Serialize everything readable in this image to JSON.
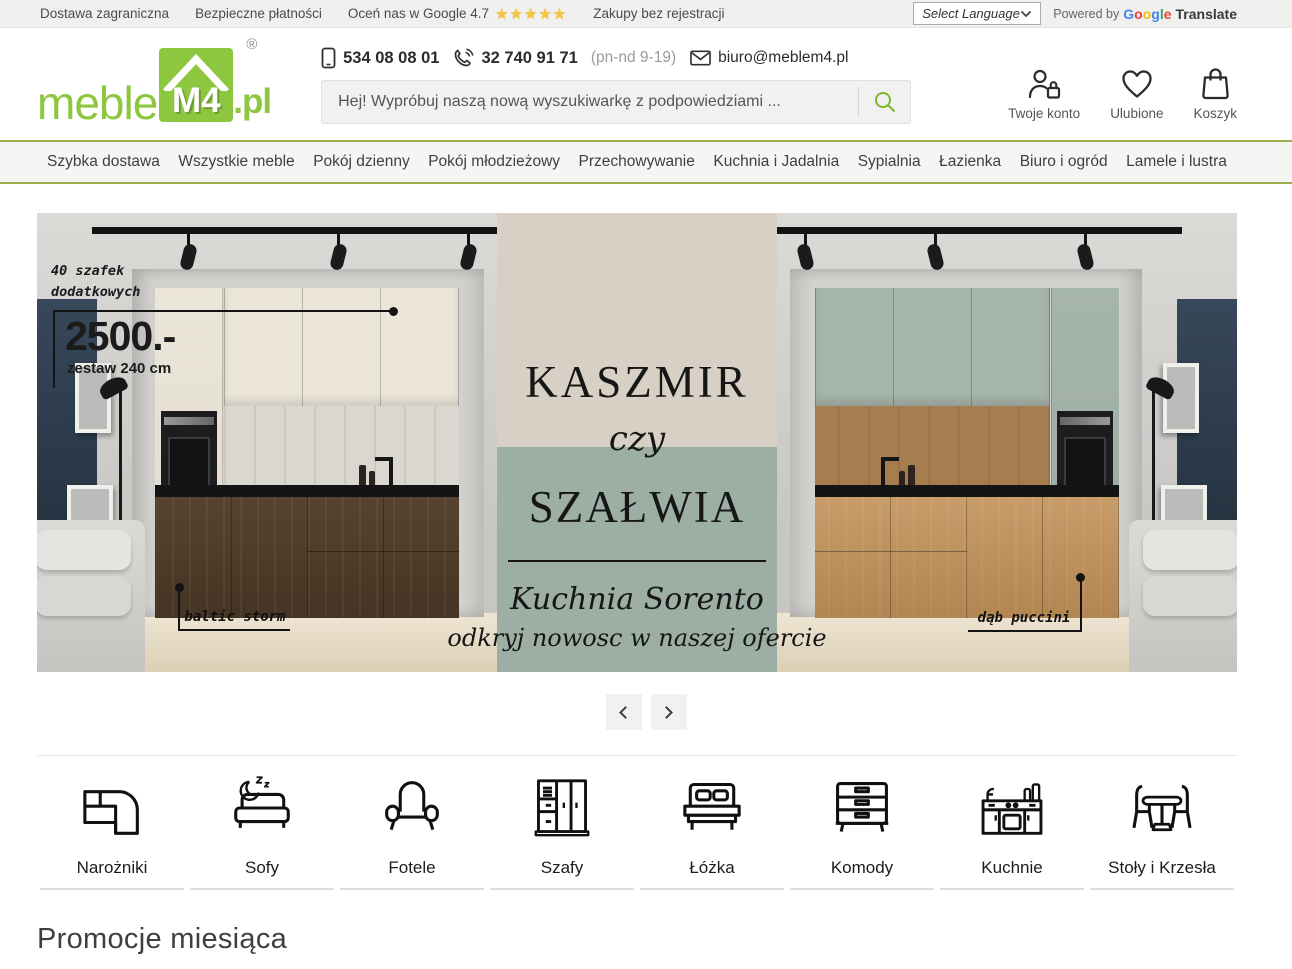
{
  "topbar": {
    "link_foreign_delivery": "Dostawa zagraniczna",
    "link_secure_payments": "Bezpieczne płatności",
    "link_google_rating": "Oceń nas w Google 4.7",
    "stars": "★★★★★",
    "link_no_registration": "Zakupy bez rejestracji",
    "language_select_label": "Select Language",
    "powered_by": "Powered by",
    "google_letters": [
      "G",
      "o",
      "o",
      "g",
      "l",
      "e"
    ],
    "translate": "Translate"
  },
  "header": {
    "logo": {
      "meble": "meble",
      "m4": "M4",
      "pl": ".pl",
      "registered": "®"
    },
    "phone_mobile": "534 08 08 01",
    "phone_landline": "32 740 91 71",
    "phone_hours": "(pn-nd 9-19)",
    "email": "biuro@meblem4.pl",
    "search_placeholder": "Hej! Wypróbuj naszą nową wyszukiwarkę z podpowiedziami ...",
    "account_label": "Twoje konto",
    "favorites_label": "Ulubione",
    "cart_label": "Koszyk"
  },
  "nav": {
    "items": [
      {
        "label": "Szybka dostawa"
      },
      {
        "label": "Wszystkie meble"
      },
      {
        "label": "Pokój dzienny"
      },
      {
        "label": "Pokój młodzieżowy"
      },
      {
        "label": "Przechowywanie"
      },
      {
        "label": "Kuchnia i Jadalnia"
      },
      {
        "label": "Sypialnia"
      },
      {
        "label": "Łazienka"
      },
      {
        "label": "Biuro i ogród"
      },
      {
        "label": "Lamele i lustra"
      }
    ]
  },
  "hero": {
    "badge_line1": "40 szafek",
    "badge_line2": "dodatkowych",
    "price": "2500.-",
    "price_sub": "zestaw 240 cm",
    "left_material": "baltic storm",
    "right_material": "dąb puccini",
    "title_top": "KASZMIR",
    "title_mid": "czy",
    "title_bottom": "SZAŁWIA",
    "script_line1": "Kuchnia Sorento",
    "script_line2": "odkryj nowosc w naszej ofercie",
    "colors": {
      "beige": "#d8d0c5",
      "sage": "#9dafa4",
      "logo_green": "#8dc63f",
      "nav_border_green": "#9bb04c"
    }
  },
  "categories": {
    "items": [
      {
        "label": "Narożniki",
        "icon": "corner-sofa-icon"
      },
      {
        "label": "Sofy",
        "icon": "sofa-sleep-icon"
      },
      {
        "label": "Fotele",
        "icon": "armchair-icon"
      },
      {
        "label": "Szafy",
        "icon": "wardrobe-icon"
      },
      {
        "label": "Łóżka",
        "icon": "bed-icon"
      },
      {
        "label": "Komody",
        "icon": "dresser-icon"
      },
      {
        "label": "Kuchnie",
        "icon": "kitchen-icon"
      },
      {
        "label": "Stoły i Krzesła",
        "icon": "table-chairs-icon"
      }
    ]
  },
  "promotions": {
    "heading": "Promocje miesiąca"
  }
}
